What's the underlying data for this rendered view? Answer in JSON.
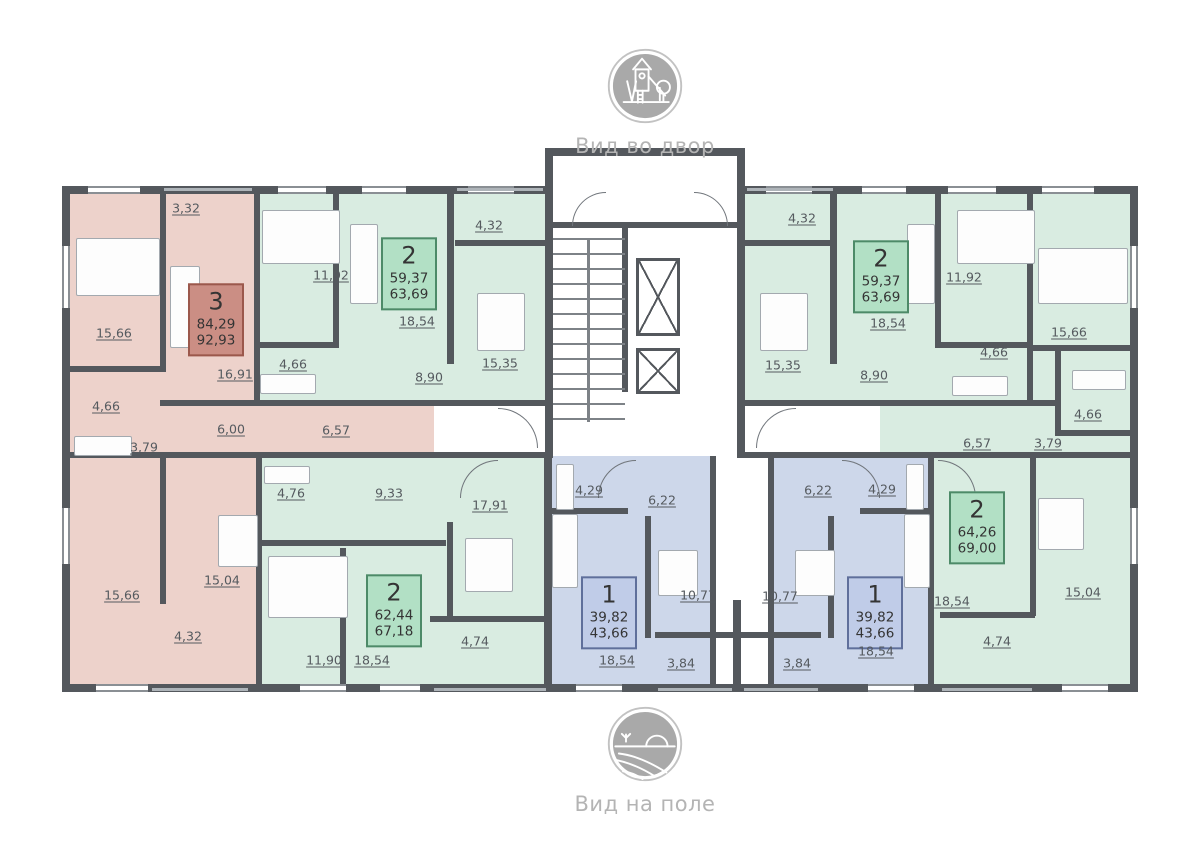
{
  "views": {
    "top": {
      "icon": "playground-icon",
      "label": "Вид во двор"
    },
    "bottom": {
      "icon": "field-icon",
      "label": "Вид на поле"
    }
  },
  "colors": {
    "wall": "#54585d",
    "apartment_3_fill": "#edd2cb",
    "apartment_2_fill": "#d9ece1",
    "apartment_1_fill": "#cdd7ea",
    "badge_3_fill": "#cb8e84",
    "badge_3_border": "#9b584c",
    "badge_2_fill": "#b2e0c5",
    "badge_2_border": "#4d8a68",
    "badge_1_fill": "#c0cce8",
    "badge_1_border": "#5f6f9b",
    "label_text": "#555a5f",
    "caption_text": "#b4b4b4",
    "icon_gray": "#a9a9a9"
  },
  "apartments": [
    {
      "id": "3",
      "rooms_count": "3",
      "living_area": "84,29",
      "total_area": "92,93",
      "fill": "#edd2cb",
      "badge": {
        "x": 216,
        "y": 320,
        "fill": "#cb8e84",
        "border": "#9b584c"
      },
      "rooms": [
        {
          "area": "3,32",
          "x": 186,
          "y": 208
        },
        {
          "area": "15,66",
          "x": 114,
          "y": 333
        },
        {
          "area": "16,91",
          "x": 235,
          "y": 374
        },
        {
          "area": "4,66",
          "x": 106,
          "y": 406
        },
        {
          "area": "6,00",
          "x": 231,
          "y": 429
        },
        {
          "area": "6,57",
          "x": 336,
          "y": 430
        },
        {
          "area": "3,79",
          "x": 144,
          "y": 447
        },
        {
          "area": "15,04",
          "x": 222,
          "y": 580
        },
        {
          "area": "15,66",
          "x": 122,
          "y": 595
        },
        {
          "area": "4,32",
          "x": 188,
          "y": 636
        }
      ]
    },
    {
      "id": "2a",
      "rooms_count": "2",
      "living_area": "59,37",
      "total_area": "63,69",
      "fill": "#d9ece1",
      "badge": {
        "x": 409,
        "y": 274,
        "fill": "#b2e0c5",
        "border": "#4d8a68"
      },
      "rooms": [
        {
          "area": "4,32",
          "x": 489,
          "y": 225
        },
        {
          "area": "11,92",
          "x": 331,
          "y": 275
        },
        {
          "area": "18,54",
          "x": 417,
          "y": 321
        },
        {
          "area": "15,35",
          "x": 500,
          "y": 363
        },
        {
          "area": "4,66",
          "x": 293,
          "y": 364
        },
        {
          "area": "8,90",
          "x": 429,
          "y": 377
        }
      ]
    },
    {
      "id": "2b",
      "rooms_count": "2",
      "living_area": "59,37",
      "total_area": "63,69",
      "fill": "#d9ece1",
      "badge": {
        "x": 881,
        "y": 277,
        "fill": "#b2e0c5",
        "border": "#4d8a68"
      },
      "rooms": [
        {
          "area": "4,32",
          "x": 802,
          "y": 218
        },
        {
          "area": "11,92",
          "x": 964,
          "y": 277
        },
        {
          "area": "18,54",
          "x": 888,
          "y": 323
        },
        {
          "area": "15,35",
          "x": 783,
          "y": 365
        },
        {
          "area": "4,66",
          "x": 994,
          "y": 352
        },
        {
          "area": "8,90",
          "x": 874,
          "y": 375
        }
      ]
    },
    {
      "id": "2c",
      "rooms_count": "2",
      "living_area": "62,44",
      "total_area": "67,18",
      "fill": "#d9ece1",
      "badge": {
        "x": 394,
        "y": 611,
        "fill": "#b2e0c5",
        "border": "#4d8a68"
      },
      "rooms": [
        {
          "area": "4,76",
          "x": 291,
          "y": 493
        },
        {
          "area": "9,33",
          "x": 389,
          "y": 493
        },
        {
          "area": "17,91",
          "x": 490,
          "y": 505
        },
        {
          "area": "11,90",
          "x": 324,
          "y": 660
        },
        {
          "area": "18,54",
          "x": 372,
          "y": 660
        },
        {
          "area": "4,74",
          "x": 475,
          "y": 641
        }
      ]
    },
    {
      "id": "2d",
      "rooms_count": "2",
      "living_area": "64,26",
      "total_area": "69,00",
      "fill": "#d9ece1",
      "badge": {
        "x": 977,
        "y": 528,
        "fill": "#b2e0c5",
        "border": "#4d8a68"
      },
      "rooms": [
        {
          "area": "15,66",
          "x": 1069,
          "y": 332
        },
        {
          "area": "4,66",
          "x": 1088,
          "y": 414
        },
        {
          "area": "6,57",
          "x": 977,
          "y": 443
        },
        {
          "area": "3,79",
          "x": 1048,
          "y": 443
        },
        {
          "area": "15,04",
          "x": 1083,
          "y": 592
        },
        {
          "area": "18,54",
          "x": 952,
          "y": 601
        },
        {
          "area": "4,74",
          "x": 997,
          "y": 641
        }
      ]
    },
    {
      "id": "1a",
      "rooms_count": "1",
      "living_area": "39,82",
      "total_area": "43,66",
      "fill": "#cdd7ea",
      "badge": {
        "x": 609,
        "y": 613,
        "fill": "#c0cce8",
        "border": "#5f6f9b"
      },
      "rooms": [
        {
          "area": "4,29",
          "x": 589,
          "y": 490
        },
        {
          "area": "6,22",
          "x": 662,
          "y": 500
        },
        {
          "area": "10,77",
          "x": 698,
          "y": 595
        },
        {
          "area": "18,54",
          "x": 617,
          "y": 660
        },
        {
          "area": "3,84",
          "x": 681,
          "y": 663
        }
      ]
    },
    {
      "id": "1b",
      "rooms_count": "1",
      "living_area": "39,82",
      "total_area": "43,66",
      "fill": "#cdd7ea",
      "badge": {
        "x": 875,
        "y": 613,
        "fill": "#c0cce8",
        "border": "#5f6f9b"
      },
      "rooms": [
        {
          "area": "6,22",
          "x": 818,
          "y": 490
        },
        {
          "area": "4,29",
          "x": 882,
          "y": 489
        },
        {
          "area": "10,77",
          "x": 780,
          "y": 596
        },
        {
          "area": "18,54",
          "x": 876,
          "y": 651
        },
        {
          "area": "3,84",
          "x": 797,
          "y": 663
        }
      ]
    }
  ]
}
